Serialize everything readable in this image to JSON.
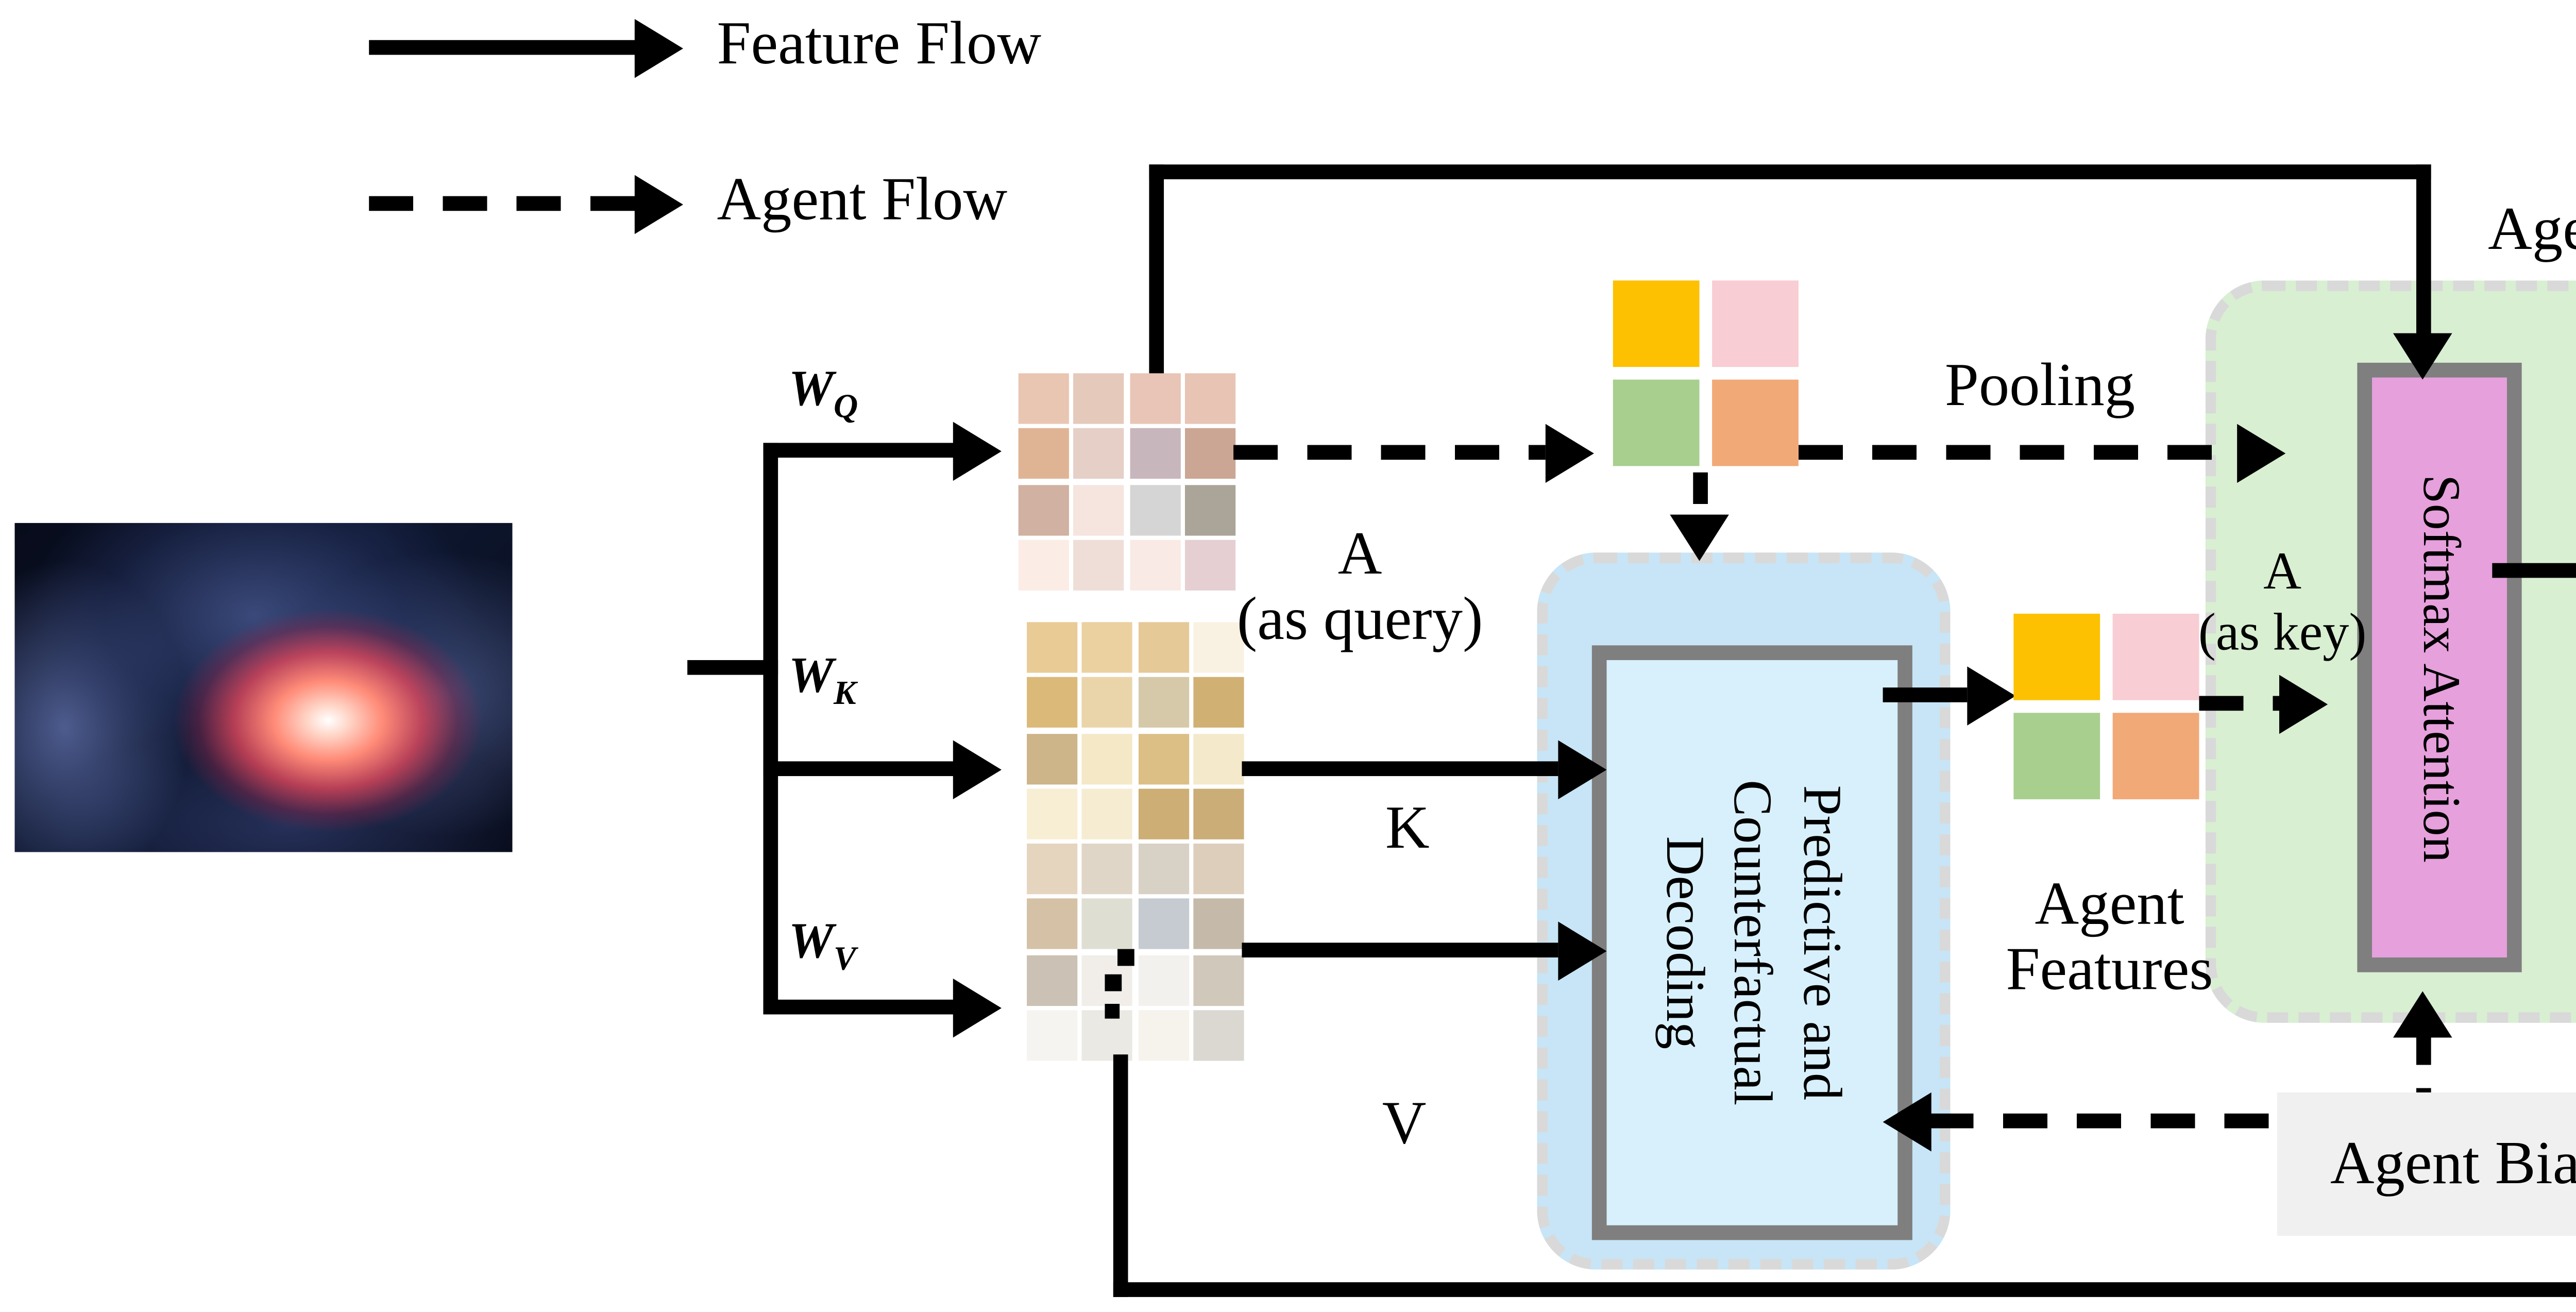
{
  "legend": {
    "feature_flow": "Feature Flow",
    "agent_flow": "Agent Flow"
  },
  "labels": {
    "wq": {
      "base": "W",
      "sub": "Q"
    },
    "wk": {
      "base": "W",
      "sub": "K"
    },
    "wv": {
      "base": "W",
      "sub": "V"
    },
    "a_query_line1": "A",
    "a_query_line2": "(as query)",
    "k": "K",
    "v": "V",
    "pooling": "Pooling",
    "agent_tokens": "Agent Tokens",
    "a_key_line1": "A",
    "a_key_line2": "(as key)",
    "agent_features_line1": "Agent",
    "agent_features_line2": "Features",
    "agent_bias": "Agent Bias"
  },
  "boxes": {
    "predictive_counterfactual_decoding": "Predictive and Counterfactual Decoding",
    "softmax_attention": "Softmax Attention",
    "dwc": "dwc"
  },
  "colors": {
    "vars": {
      "blue-fill": "#c7e5f6",
      "blue-inner": "#d8f0fb",
      "green-fill": "#d8efd2",
      "pink-softmax": "#e6a0dc",
      "pink-dwc": "#f6dcf5",
      "dwc-inner": "#dbe9f6",
      "gray-box": "#f0f0f0",
      "border-gray": "#7f7f7f",
      "dash-gray": "#d9d9d9"
    },
    "line_color": "#000000"
  },
  "grids": {
    "q": [
      [
        "#e9c6b2",
        "#e5c9ba",
        "#e8c5b6",
        "#e7c4b4"
      ],
      [
        "#dfb495",
        "#e5cfc7",
        "#c8b6bd",
        "#cba694"
      ],
      [
        "#d1b1a1",
        "#f5e5de",
        "#d5d5d5",
        "#aaa598"
      ],
      [
        "#fbede6",
        "#efded8",
        "#f9eae5",
        "#e5cfd2"
      ]
    ],
    "k": [
      [
        "#e9cb95",
        "#ebd1a0",
        "#e5c997",
        "#f9f2e2"
      ],
      [
        "#dbb979",
        "#ead5aa",
        "#d5c9aa",
        "#d1b074"
      ],
      [
        "#cdb489",
        "#f4e8c7",
        "#dbbf85",
        "#f5e9cb"
      ],
      [
        "#f7eed4",
        "#f5ecd2",
        "#cdae74",
        "#cbad78"
      ]
    ],
    "v": [
      [
        "#e5d5bf",
        "#e0d6c7",
        "#d8d1c6",
        "#ddcebc"
      ],
      [
        "#d5c1a6",
        "#deded3",
        "#c5cbd1",
        "#c5b9aa"
      ],
      [
        "#cbc1b4",
        "#f1eee9",
        "#f3f1ed",
        "#d1c8bc"
      ],
      [
        "#f6f4f0",
        "#ebe9e3",
        "#f6f3ec",
        "#dbd8d2"
      ]
    ],
    "pool": [
      [
        "#fdc101",
        "#f8cdd3"
      ],
      [
        "#a8cf8e",
        "#f1a978"
      ]
    ],
    "agent": [
      [
        "#fdc101",
        "#f8cdd3"
      ],
      [
        "#a8cf8e",
        "#f1a978"
      ]
    ],
    "output": [
      [
        "#d0bda4",
        "#cbbfab",
        "#bdb8ac",
        "#c2b29d"
      ],
      [
        "#c0a988",
        "#cdc9c3",
        "#a4abb5",
        "#a59a8b"
      ],
      [
        "#aaa093",
        "#d5d3cb",
        "#d4d5d1",
        "#b4a99c"
      ],
      [
        "#dcdedd",
        "#cfcfc9",
        "#d9d8d2",
        "#b3b3b3"
      ]
    ]
  }
}
